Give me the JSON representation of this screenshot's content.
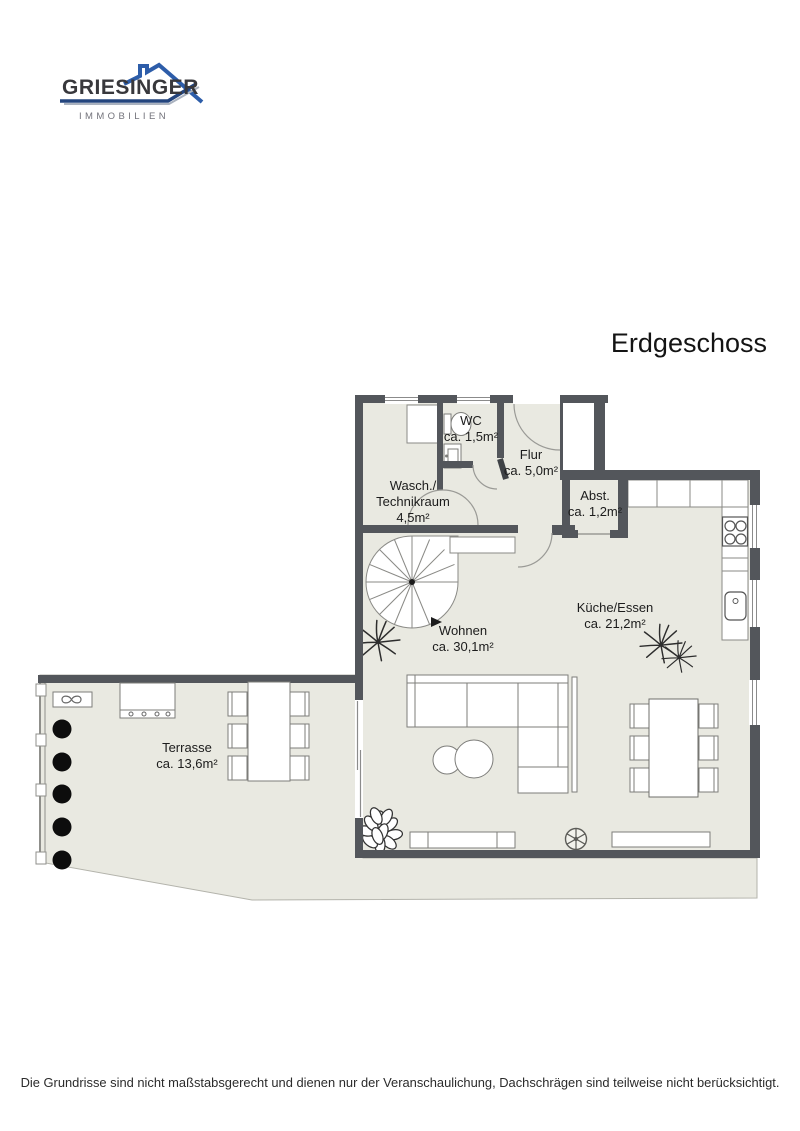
{
  "logo": {
    "brand": "GRIESINGER",
    "tagline": "IMMOBILIEN"
  },
  "floor_title": "Erdgeschoss",
  "rooms": {
    "wc": {
      "name": "WC",
      "area": "ca. 1,5m²"
    },
    "flur": {
      "name": "Flur",
      "area": "ca. 5,0m²"
    },
    "wasch": {
      "name_line1": "Wasch./",
      "name_line2": "Technikraum",
      "area": "4,5m²"
    },
    "abst": {
      "name": "Abst.",
      "area": "ca. 1,2m²"
    },
    "kueche": {
      "name": "Küche/Essen",
      "area": "ca. 21,2m²"
    },
    "wohnen": {
      "name": "Wohnen",
      "area": "ca. 30,1m²"
    },
    "terrasse": {
      "name": "Terrasse",
      "area": "ca. 13,6m²"
    }
  },
  "disclaimer": "Die Grundrisse sind nicht maßstabsgerecht und dienen nur der Veranschaulichung, Dachschrägen sind teilweise nicht berücksichtigt.",
  "colors": {
    "wall": "#53565b",
    "floor": "#e9e9e1",
    "furniture_outline": "#82827e",
    "logo_blue": "#2d5da9",
    "logo_navy": "#24457e",
    "text": "#1c1c1c"
  },
  "icons": [
    "spiral-staircase-icon",
    "corner-sofa-icon",
    "coffee-table-icon",
    "tv-sideboard-icon",
    "dining-table-icon",
    "chair-icon",
    "kitchen-counter-icon",
    "stove-icon",
    "sink-icon",
    "toilet-icon",
    "washbasin-icon",
    "washing-machine-icon",
    "ceiling-fan-icon",
    "plant-icon",
    "hedge-bush-icon",
    "railing-icon",
    "grill-icon",
    "sun-lounger-icon",
    "door-swing-icon",
    "window-icon"
  ]
}
